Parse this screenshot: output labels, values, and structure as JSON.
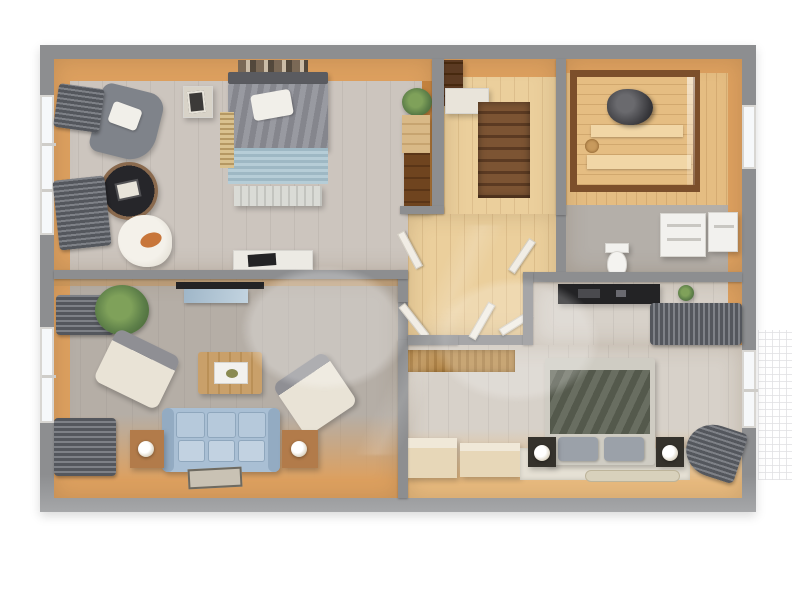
{
  "scene": {
    "kind": "3d-rendered apartment floor plan, top-down view",
    "background": "white margin around a gray-walled plan",
    "watermark_visible": true
  },
  "palette": {
    "wall": "#8d8e90",
    "wall_light": "#a6a7a9",
    "wood": "#dda05f",
    "wood_deep": "#c8853f",
    "wood_light": "#e8ba7e",
    "pine": "#ebcf9c",
    "b1_floor": "#ccc5be",
    "lv_floor": "#b5aea6",
    "b2_floor": "#d7d1c9",
    "tile": "#b4afa9",
    "stair": "#7c5433",
    "stair_dark": "#5b3a22",
    "sauna_frame": "#7c4f2b",
    "sauna_wood": "#e5bd82",
    "sofa": "#a9bfd4",
    "duvet1": "#8d8e96",
    "blanket1": "#a6c2ce",
    "duvet2": "#5e6355",
    "curtain": "#54575d",
    "door": "#f1ede5",
    "window": "#f6f8fa",
    "dark": "#232325",
    "cream": "#e9e3d6",
    "plant": "#5d7f49",
    "oak": "#b27b4a",
    "rug_tan": "#b98d4f"
  },
  "rooms": [
    {
      "id": "bedroom-1",
      "name": "Bedroom 1 (top left)",
      "furniture": [
        "double bed with gray duvet, white pillow, light-blue blanket",
        "headboard",
        "bedside cube with picture frame",
        "slatted runner rug",
        "gray armchair with white pillow",
        "round dark coffee table",
        "white fluffy chair with cat",
        "white desk console",
        "wardrobe cabinets",
        "potted plant",
        "left window with dark curtains",
        "wall shelf clutter"
      ]
    },
    {
      "id": "hallway-stairs",
      "name": "Stair hall (top middle)",
      "furniture": [
        "dark wood staircase",
        "dark shelf unit",
        "white counter",
        "four white door leaves"
      ]
    },
    {
      "id": "sauna-bathroom",
      "name": "Sauna and bathroom (top right)",
      "furniture": [
        "glass-front sauna cabin with wood frame",
        "sauna heater with stones",
        "sauna benches",
        "toilet",
        "stacked washer cabinets",
        "right window",
        "tiled floor"
      ]
    },
    {
      "id": "living-room",
      "name": "Living room (bottom left)",
      "furniture": [
        "light blue three-seat sofa",
        "two cream armchairs",
        "wooden coffee table with tray",
        "two wooden side tables with lamps",
        "wall TV",
        "potted plant",
        "small rug",
        "left window with dark curtains"
      ]
    },
    {
      "id": "bedroom-2",
      "name": "Bedroom 2 (bottom right)",
      "furniture": [
        "double bed with olive duvet and gray pillows",
        "two dark nightstands with lamps",
        "black TV console",
        "woven tan rug",
        "low wooden benches",
        "bed rug and runner",
        "small plant",
        "right window with gathered gray curtains",
        "outdoor lattice"
      ]
    }
  ]
}
